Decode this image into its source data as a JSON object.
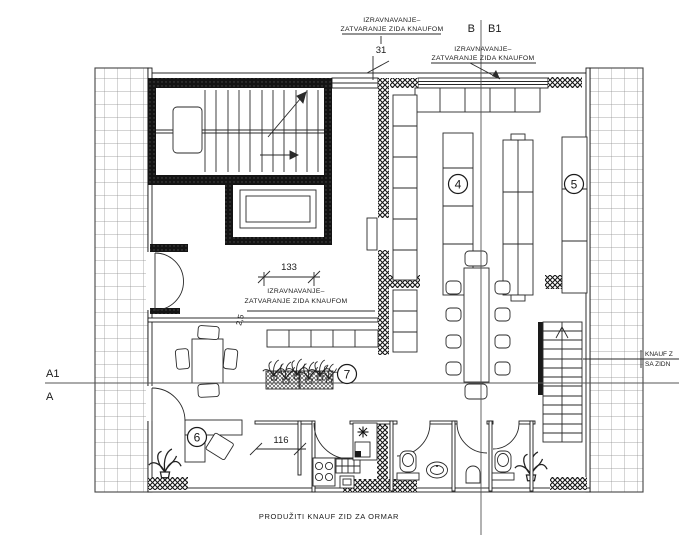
{
  "drawing_type": "architectural-floor-plan",
  "labels": {
    "knauf_notes": [
      {
        "line1": "IZRAVNAVANJE–",
        "line2": "ZATVARANJE ZIDA KNAUFOM"
      },
      {
        "line1": "IZRAVNAVANJE–",
        "line2": "ZATVARANJE ZIDA KNAUFOM"
      },
      {
        "line1": "IZRAVNAVANJE–",
        "line2": "ZATVARANJE ZIDA KNAUFOM"
      }
    ],
    "right_note": {
      "line1": "KNAUF Z",
      "line2": "SA ZIDN"
    },
    "bottom_note": "PRODUŽITI KNAUF ZID ZA ORMAR",
    "sections": {
      "b": "B",
      "b1": "B1",
      "a1": "A1",
      "a": "A"
    },
    "dimensions": {
      "opening_width": "133",
      "wardrobe_width": "116",
      "knauf_offset": "31",
      "wall_thickness": "2,5"
    },
    "rooms": [
      {
        "number": "4"
      },
      {
        "number": "5"
      },
      {
        "number": "6"
      },
      {
        "number": "7"
      }
    ]
  },
  "colors": {
    "ink": "#1a1a1a",
    "paper": "#ffffff",
    "grid": "#8c8c8c"
  }
}
